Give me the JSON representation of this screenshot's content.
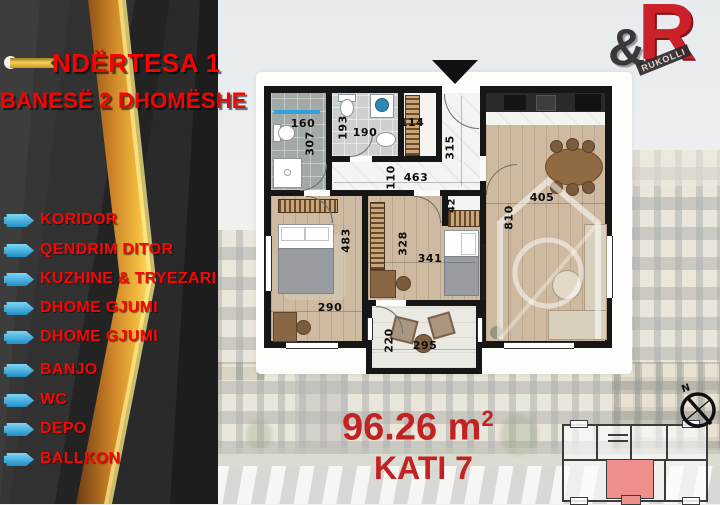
{
  "sidebar": {
    "title": "NDËRTESA 1",
    "subtitle": "BANESË 2 DHOMËSHE",
    "items": [
      {
        "label": "KORIDOR"
      },
      {
        "label": "QENDRIM DITOR"
      },
      {
        "label": "KUZHINE & TRYEZARI"
      },
      {
        "label": "DHOME GJUMI"
      },
      {
        "label": "DHOME GJUMI"
      },
      {
        "label": "BANJO"
      },
      {
        "label": "WC"
      },
      {
        "label": "DEPO"
      },
      {
        "label": "BALLKON"
      }
    ]
  },
  "logo": {
    "ampersand": "&",
    "letter": "R",
    "brand": "RUKOLLI"
  },
  "floor_plan": {
    "dimensions": [
      {
        "value": "160"
      },
      {
        "value": "307"
      },
      {
        "value": "193"
      },
      {
        "value": "190"
      },
      {
        "value": "114"
      },
      {
        "value": "315"
      },
      {
        "value": "110"
      },
      {
        "value": "463"
      },
      {
        "value": "42"
      },
      {
        "value": "405"
      },
      {
        "value": "810"
      },
      {
        "value": "483"
      },
      {
        "value": "290"
      },
      {
        "value": "328"
      },
      {
        "value": "341"
      },
      {
        "value": "220"
      },
      {
        "value": "295"
      }
    ]
  },
  "footer": {
    "area_value": "96.26",
    "area_unit": "m",
    "area_exponent": "2",
    "floor_label": "KATI 7"
  },
  "compass": {
    "north_label": "N"
  },
  "colors": {
    "accent_red": "#f50404",
    "deep_red": "#c32222",
    "icon_blue": "#2fa3dc",
    "gold": "#f4d05c",
    "unit_highlight": "#ef8f8c"
  }
}
